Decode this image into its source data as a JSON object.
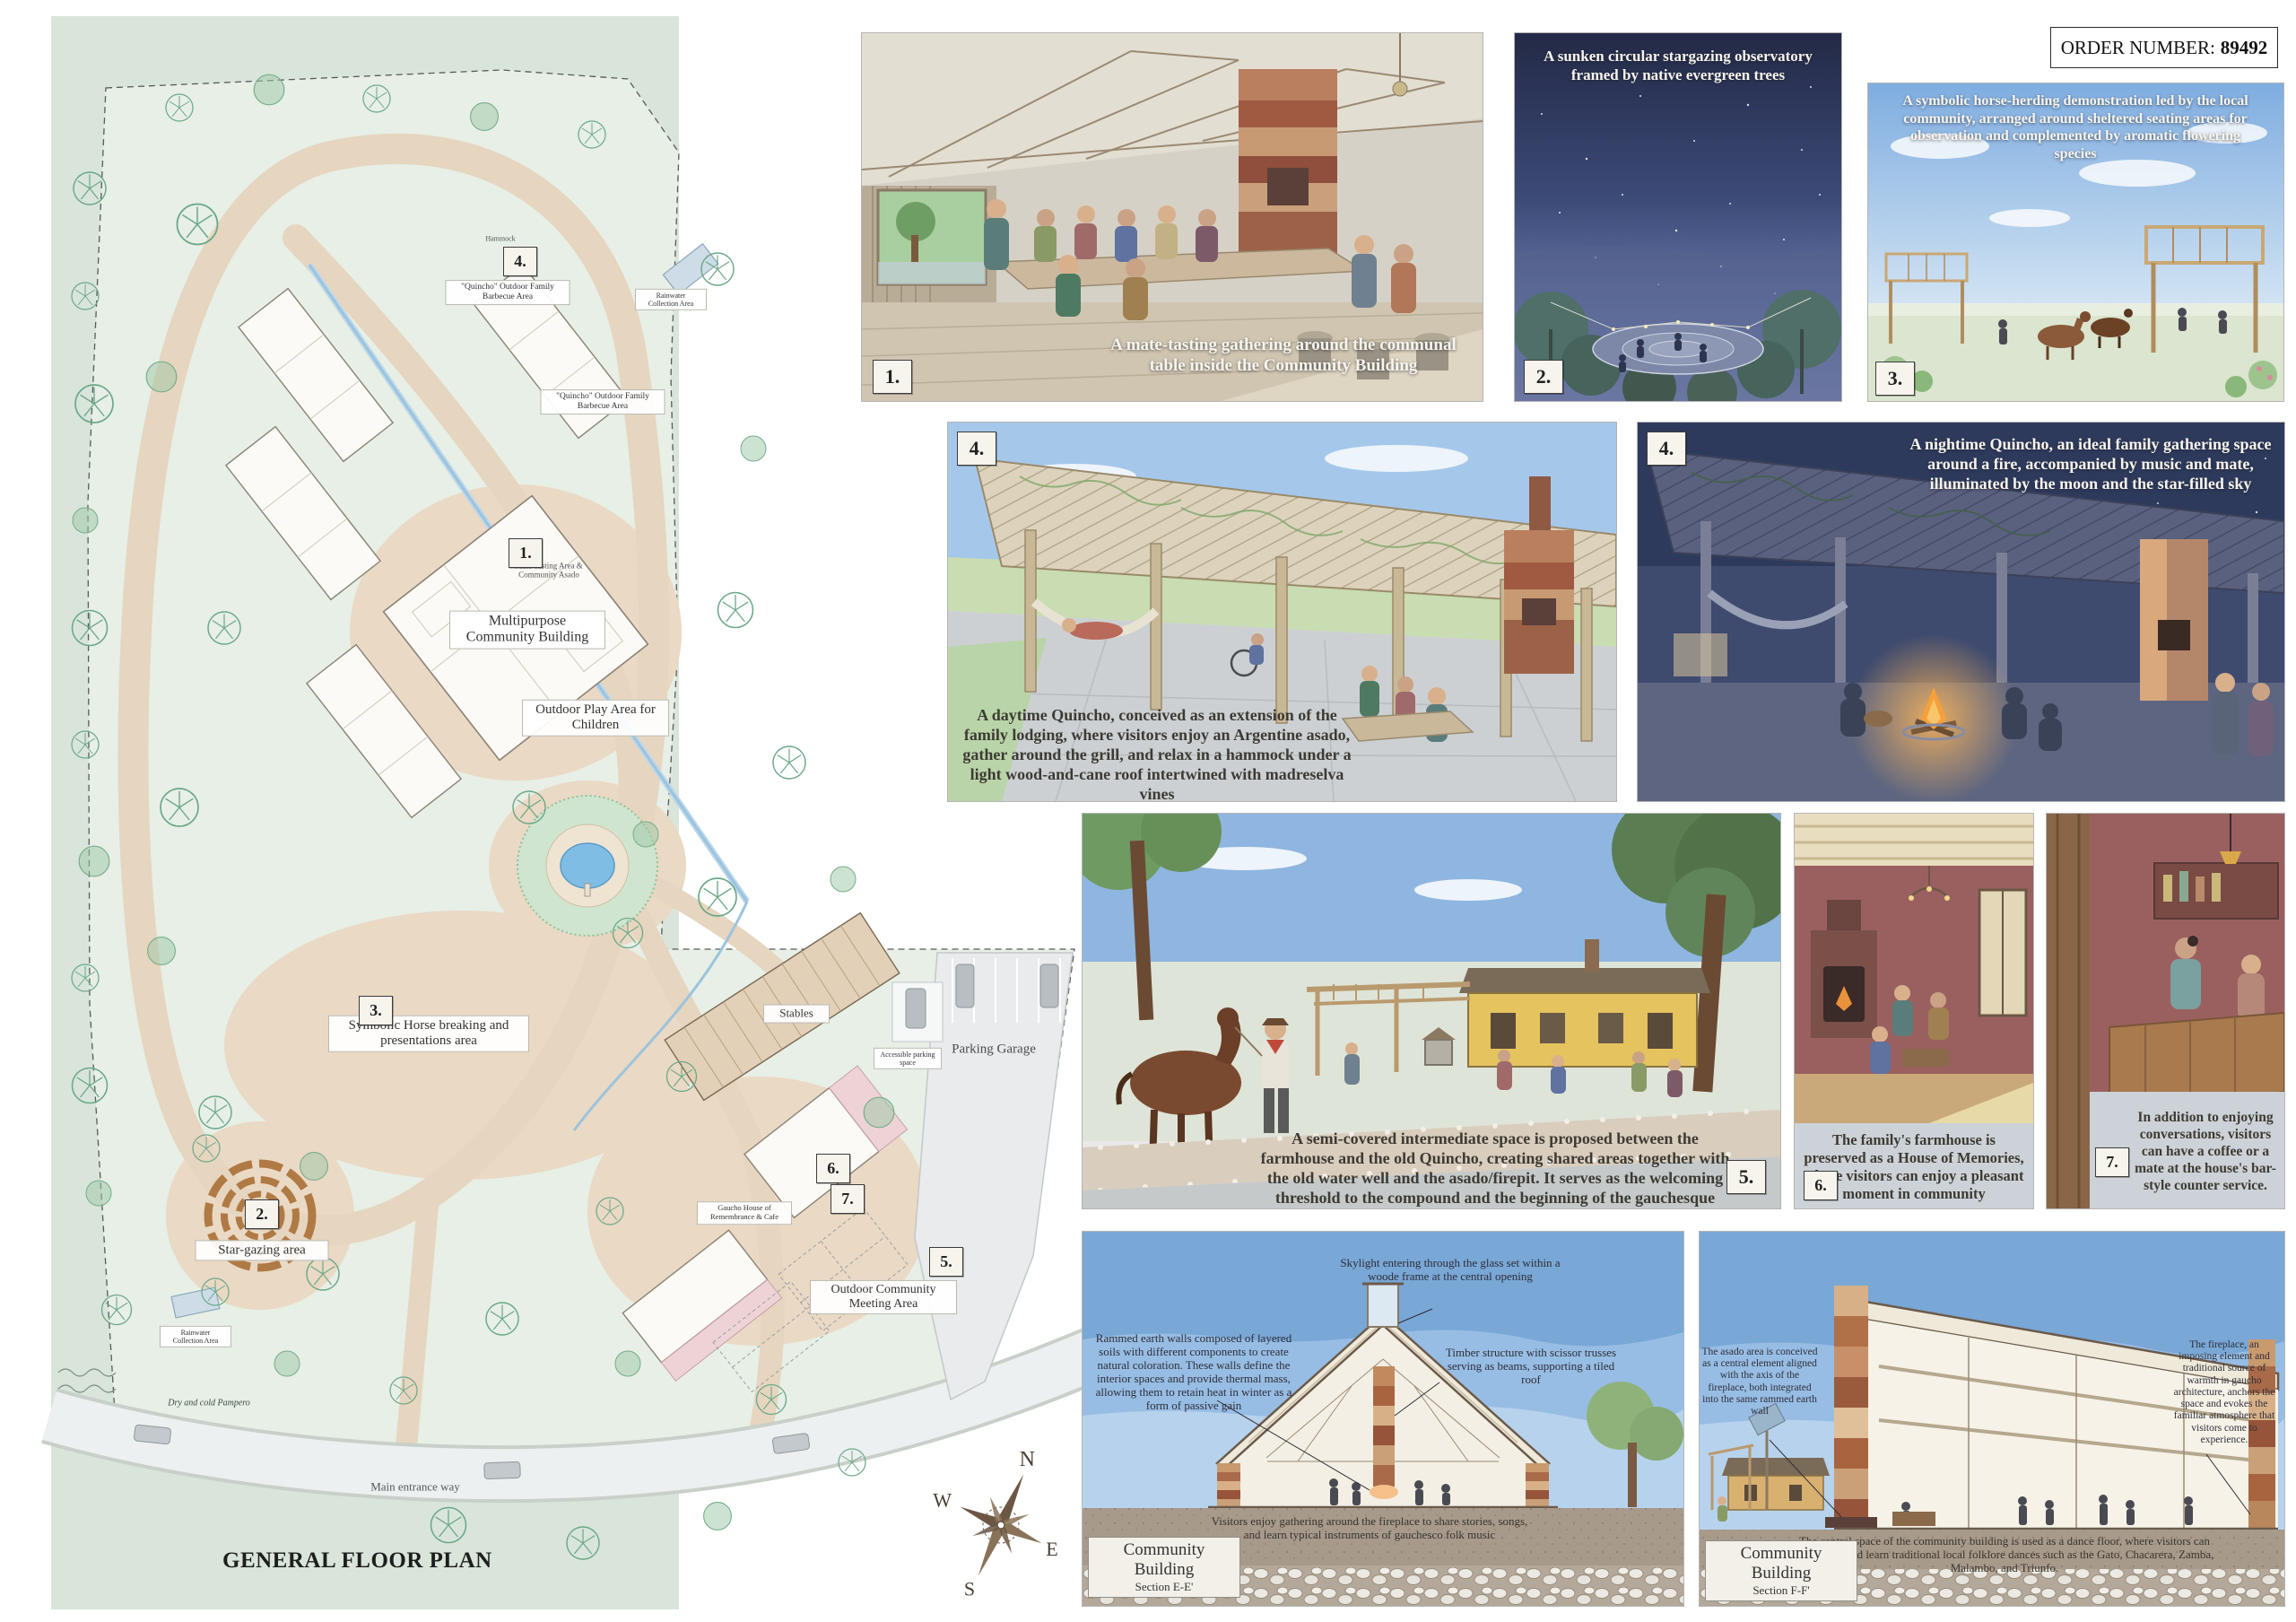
{
  "order": {
    "label": "ORDER NUMBER:",
    "value": "89492"
  },
  "colors": {
    "plan_backdrop": "#d9e5da",
    "path_tan": "#e6d5bf",
    "water_blue": "#7fbde4",
    "day_sky": "#79a7d6",
    "night_sky": "#232a46",
    "soil_brown": "#a79a8b",
    "fire_orange": "#f6a03c",
    "tree_green": "#6aa887",
    "maroon_wall": "#9a6060"
  },
  "plan": {
    "title": "GENERAL FLOOR PLAN",
    "compass": {
      "n": "N",
      "e": "E",
      "s": "S",
      "w": "W"
    },
    "badges": {
      "b1": "1.",
      "b2": "2.",
      "b3": "3.",
      "b4": "4.",
      "b5": "5.",
      "b6": "6.",
      "b7": "7."
    },
    "labels": {
      "multipurpose": "Multipurpose Community Building",
      "mate_area": "Mate Tasting Area & Community Asado",
      "play_area": "Outdoor Play Area for Children",
      "quincho": "\"Quincho\" Outdoor Family Barbecue Area",
      "horse_area": "Symbolic Horse breaking and presentations area",
      "stargazing": "Star-gazing area",
      "stables": "Stables",
      "parking": "Parking Garage",
      "accessible_parking": "Accessible parking space",
      "meeting_area": "Outdoor Community Meeting Area",
      "memories_house": "Gaucho House of Remembrance & Cafe",
      "main_entrance": "Main entrance way",
      "rainwater": "Rainwater Collection Area",
      "pampero": "Dry and cold Pampero",
      "hammock": "Hammock"
    }
  },
  "panels": {
    "p1": {
      "number": "1.",
      "caption": "A mate-tasting gathering around the communal table inside the Community Building"
    },
    "p2": {
      "number": "2.",
      "caption": "A sunken circular stargazing observatory framed by native evergreen trees"
    },
    "p3": {
      "number": "3.",
      "caption": "A symbolic horse-herding demonstration led by the local community, arranged around sheltered seating areas for observation and complemented by aromatic flowering species"
    },
    "p4day": {
      "number": "4.",
      "caption": "A daytime Quincho, conceived as an extension of the family lodging, where visitors enjoy an Argentine asado, gather around the grill, and relax in a hammock under a light wood-and-cane roof intertwined with madreselva vines"
    },
    "p4night": {
      "number": "4.",
      "caption": "A nightime Quincho, an ideal family gathering space around a fire, accompanied by music and mate, illuminated by the moon and the star-filled sky"
    },
    "p5": {
      "number": "5.",
      "caption": "A semi-covered intermediate space is proposed between the farmhouse and the old Quincho, creating shared areas together with the old water well and the asado/firepit. It serves as the welcoming threshold to the compound and the beginning of the gauchesque experience"
    },
    "p6": {
      "number": "6.",
      "caption": "The family's farmhouse is preserved as a House of Memories, where visitors can enjoy a pleasant moment in community"
    },
    "p7": {
      "number": "7.",
      "caption": "In addition to enjoying conversations, visitors can have a coffee or a mate at the house's bar-style counter service."
    }
  },
  "sections": {
    "e": {
      "title_line1": "Community Building",
      "title_line2": "Section E-E'",
      "ann_skylight": "Skylight entering through the glass set within a woode frame at the central opening",
      "ann_walls": "Rammed earth walls composed of layered soils with different components to create natural coloration. These walls define the interior spaces and provide thermal mass, allowing them to retain heat in winter as a form of passive gain",
      "ann_timber": "Timber structure with scissor trusses serving as beams, supporting a tiled roof",
      "caption": "Visitors enjoy gathering around the fireplace to share stories, songs, and learn typical instruments of gauchesco folk music"
    },
    "f": {
      "title_line1": "Community Building",
      "title_line2": "Section F-F'",
      "ann_asado": "The asado area is conceived as a central element aligned with the axis of the fireplace, both integrated into the same rammed earth wall",
      "ann_fireplace": "The fireplace, an imposing element and traditional source of warmth in gaucho architecture, anchors the space and evokes the familiar atmosphere that visitors come to experience.",
      "caption": "The central space of the community building is used as a dance floor, where visitors can appreciate and learn traditional local folklore dances such as the Gato, Chacarera, Zamba, Malambo, and Triunfo."
    }
  }
}
